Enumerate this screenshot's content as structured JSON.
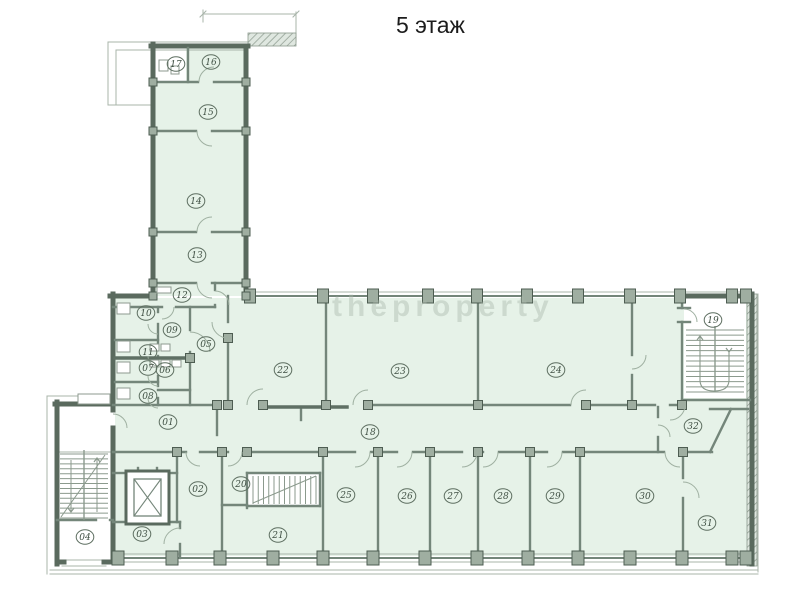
{
  "title": "5 этаж",
  "watermark": "theproperty",
  "colors": {
    "room_fill": "#e6f2e8",
    "white": "#ffffff",
    "wall_ext": "#5a6a5e",
    "wall_int": "#74867a",
    "wall_dark": "#5f7064",
    "thin": "#a8b4aa",
    "door": "#9fb0a1",
    "stair": "#8b9a8d",
    "post_fill": "#9fae a1",
    "post_fill_fixed": "#9faea1",
    "post_stroke": "#4e5d52",
    "label": "#3f4f43",
    "label_ring": "#5d6e60",
    "fixture": "#8d9a8f",
    "hatch": "#8b998d"
  },
  "rooms": [
    {
      "n": "01",
      "x": 168,
      "y": 422
    },
    {
      "n": "02",
      "x": 198,
      "y": 489
    },
    {
      "n": "03",
      "x": 142,
      "y": 534
    },
    {
      "n": "04",
      "x": 85,
      "y": 537
    },
    {
      "n": "05",
      "x": 206,
      "y": 344
    },
    {
      "n": "06",
      "x": 165,
      "y": 370
    },
    {
      "n": "07",
      "x": 148,
      "y": 368
    },
    {
      "n": "08",
      "x": 148,
      "y": 396
    },
    {
      "n": "09",
      "x": 172,
      "y": 330
    },
    {
      "n": "10",
      "x": 146,
      "y": 313
    },
    {
      "n": "11",
      "x": 148,
      "y": 352
    },
    {
      "n": "12",
      "x": 182,
      "y": 295
    },
    {
      "n": "13",
      "x": 197,
      "y": 255
    },
    {
      "n": "14",
      "x": 196,
      "y": 201
    },
    {
      "n": "15",
      "x": 208,
      "y": 112
    },
    {
      "n": "16",
      "x": 211,
      "y": 62
    },
    {
      "n": "17",
      "x": 176,
      "y": 64
    },
    {
      "n": "18",
      "x": 370,
      "y": 432
    },
    {
      "n": "19",
      "x": 713,
      "y": 320
    },
    {
      "n": "20",
      "x": 241,
      "y": 484
    },
    {
      "n": "21",
      "x": 278,
      "y": 535
    },
    {
      "n": "22",
      "x": 283,
      "y": 370
    },
    {
      "n": "23",
      "x": 400,
      "y": 371
    },
    {
      "n": "24",
      "x": 556,
      "y": 370
    },
    {
      "n": "25",
      "x": 346,
      "y": 495
    },
    {
      "n": "26",
      "x": 407,
      "y": 496
    },
    {
      "n": "27",
      "x": 453,
      "y": 496
    },
    {
      "n": "28",
      "x": 503,
      "y": 496
    },
    {
      "n": "29",
      "x": 555,
      "y": 496
    },
    {
      "n": "30",
      "x": 645,
      "y": 496
    },
    {
      "n": "31",
      "x": 707,
      "y": 523
    },
    {
      "n": "32",
      "x": 693,
      "y": 426
    }
  ],
  "plan": {
    "green": [
      [
        155,
        48,
        89,
        248
      ],
      [
        115,
        298,
        635,
        258
      ]
    ],
    "white": [
      [
        155,
        48,
        31,
        34
      ],
      [
        684,
        298,
        62,
        100
      ],
      [
        248,
        474,
        71,
        31
      ],
      [
        126,
        471,
        43,
        53
      ]
    ],
    "walls_ext": [
      [
        153,
        44,
        153,
        298
      ],
      [
        151,
        46,
        248,
        46
      ],
      [
        246,
        46,
        246,
        298
      ],
      [
        110,
        296,
        155,
        296
      ],
      [
        680,
        296,
        750,
        296
      ],
      [
        113,
        294,
        113,
        410
      ],
      [
        113,
        428,
        113,
        562
      ],
      [
        752,
        294,
        752,
        564
      ],
      [
        57,
        402,
        57,
        564
      ],
      [
        55,
        404,
        113,
        404
      ],
      [
        57,
        562,
        64,
        562
      ],
      [
        104,
        562,
        113,
        562
      ]
    ],
    "walls_glass": [
      [
        244,
        296,
        680,
        296
      ],
      [
        113,
        558,
        752,
        558
      ]
    ],
    "walls_int": [
      [
        188,
        48,
        188,
        82
      ],
      [
        153,
        82,
        198,
        82
      ],
      [
        214,
        82,
        246,
        82
      ],
      [
        153,
        131,
        196,
        131
      ],
      [
        212,
        131,
        246,
        131
      ],
      [
        153,
        232,
        196,
        232
      ],
      [
        212,
        232,
        246,
        232
      ],
      [
        153,
        283,
        196,
        283
      ],
      [
        212,
        283,
        246,
        283
      ],
      [
        215,
        283,
        215,
        290
      ],
      [
        215,
        305,
        215,
        307
      ],
      [
        113,
        307,
        162,
        307
      ],
      [
        176,
        307,
        215,
        307
      ],
      [
        158,
        307,
        158,
        312
      ],
      [
        158,
        324,
        158,
        344
      ],
      [
        158,
        356,
        158,
        364
      ],
      [
        158,
        376,
        158,
        386
      ],
      [
        158,
        398,
        158,
        405
      ],
      [
        115,
        340,
        158,
        340
      ],
      [
        115,
        382,
        158,
        382
      ],
      [
        158,
        390,
        190,
        390
      ],
      [
        190,
        307,
        190,
        330
      ],
      [
        190,
        352,
        190,
        405
      ],
      [
        228,
        296,
        228,
        322
      ],
      [
        228,
        338,
        228,
        405
      ],
      [
        326,
        296,
        326,
        405
      ],
      [
        478,
        296,
        478,
        405
      ],
      [
        632,
        296,
        632,
        355
      ],
      [
        632,
        375,
        632,
        405
      ],
      [
        682,
        296,
        682,
        308
      ],
      [
        682,
        322,
        682,
        400
      ],
      [
        682,
        400,
        750,
        400
      ],
      [
        113,
        405,
        213,
        405
      ],
      [
        301,
        407,
        301,
        420
      ],
      [
        368,
        405,
        570,
        405
      ],
      [
        586,
        405,
        655,
        405
      ],
      [
        670,
        405,
        684,
        405
      ],
      [
        217,
        405,
        217,
        435
      ],
      [
        710,
        409,
        748,
        409
      ],
      [
        658,
        407,
        658,
        417
      ],
      [
        658,
        437,
        658,
        452
      ],
      [
        710,
        452,
        731,
        409
      ],
      [
        113,
        452,
        186,
        452
      ],
      [
        200,
        452,
        228,
        452
      ],
      [
        243,
        452,
        355,
        452
      ],
      [
        371,
        452,
        397,
        452
      ],
      [
        413,
        452,
        462,
        452
      ],
      [
        478,
        452,
        483,
        452
      ],
      [
        499,
        452,
        547,
        452
      ],
      [
        563,
        452,
        664,
        452
      ],
      [
        680,
        452,
        712,
        452
      ],
      [
        177,
        452,
        177,
        522
      ],
      [
        222,
        452,
        222,
        558
      ],
      [
        247,
        473,
        247,
        508
      ],
      [
        222,
        505,
        247,
        505
      ],
      [
        247,
        473,
        320,
        473
      ],
      [
        247,
        506,
        320,
        506
      ],
      [
        320,
        473,
        320,
        506
      ],
      [
        323,
        452,
        323,
        558
      ],
      [
        378,
        452,
        378,
        558
      ],
      [
        430,
        452,
        430,
        558
      ],
      [
        478,
        452,
        478,
        558
      ],
      [
        530,
        452,
        530,
        558
      ],
      [
        580,
        452,
        580,
        558
      ],
      [
        683,
        452,
        683,
        478
      ],
      [
        683,
        498,
        683,
        558
      ],
      [
        113,
        473,
        126,
        473
      ],
      [
        169,
        473,
        177,
        473
      ],
      [
        113,
        522,
        180,
        522
      ],
      [
        180,
        522,
        180,
        528
      ],
      [
        180,
        544,
        180,
        558
      ],
      [
        57,
        520,
        96,
        520
      ],
      [
        110,
        520,
        113,
        520
      ],
      [
        138,
        468,
        138,
        477
      ],
      [
        157,
        468,
        157,
        477
      ],
      [
        678,
        308,
        690,
        308
      ],
      [
        678,
        322,
        690,
        322
      ]
    ],
    "walls_dark": [
      [
        115,
        358,
        190,
        358
      ],
      [
        262,
        407,
        347,
        407
      ]
    ],
    "thin": [
      [
        108,
        42,
        296,
        42
      ],
      [
        116,
        50,
        248,
        50
      ],
      [
        108,
        42,
        108,
        105
      ],
      [
        116,
        50,
        116,
        105
      ],
      [
        108,
        105,
        153,
        105
      ],
      [
        296,
        12,
        296,
        42
      ],
      [
        203,
        14,
        296,
        14
      ],
      [
        203,
        10,
        203,
        22
      ],
      [
        200,
        17,
        206,
        11
      ],
      [
        293,
        17,
        299,
        11
      ],
      [
        246,
        292,
        748,
        292
      ],
      [
        113,
        554,
        750,
        554
      ],
      [
        113,
        562,
        750,
        562
      ],
      [
        50,
        570,
        758,
        570
      ],
      [
        50,
        574,
        758,
        574
      ],
      [
        758,
        294,
        758,
        572
      ],
      [
        47,
        396,
        47,
        574
      ],
      [
        47,
        396,
        80,
        396
      ],
      [
        57,
        452,
        113,
        452
      ],
      [
        78,
        399,
        110,
        399
      ],
      [
        62,
        560,
        106,
        560
      ],
      [
        62,
        566,
        106,
        566
      ]
    ],
    "doors": [
      [
        214,
        82,
        15,
        180,
        270
      ],
      [
        212,
        131,
        15,
        90,
        180
      ],
      [
        212,
        232,
        15,
        180,
        270
      ],
      [
        212,
        283,
        15,
        90,
        180
      ],
      [
        215,
        305,
        14,
        270,
        360
      ],
      [
        158,
        324,
        10,
        90,
        180
      ],
      [
        158,
        356,
        10,
        90,
        180
      ],
      [
        158,
        376,
        10,
        90,
        180
      ],
      [
        158,
        398,
        10,
        90,
        180
      ],
      [
        162,
        307,
        12,
        0,
        90
      ],
      [
        190,
        352,
        20,
        270,
        360
      ],
      [
        228,
        322,
        16,
        90,
        180
      ],
      [
        263,
        405,
        16,
        180,
        270
      ],
      [
        368,
        405,
        15,
        180,
        270
      ],
      [
        586,
        405,
        15,
        180,
        270
      ],
      [
        670,
        405,
        15,
        0,
        90
      ],
      [
        632,
        355,
        14,
        0,
        90
      ],
      [
        684,
        322,
        13,
        270,
        360
      ],
      [
        658,
        437,
        12,
        270,
        360
      ],
      [
        200,
        452,
        14,
        90,
        180
      ],
      [
        228,
        452,
        14,
        0,
        90
      ],
      [
        355,
        452,
        15,
        0,
        90
      ],
      [
        397,
        452,
        15,
        0,
        90
      ],
      [
        462,
        452,
        15,
        0,
        90
      ],
      [
        483,
        452,
        15,
        0,
        90
      ],
      [
        547,
        452,
        15,
        0,
        90
      ],
      [
        680,
        452,
        15,
        90,
        180
      ],
      [
        683,
        498,
        16,
        270,
        360
      ],
      [
        180,
        544,
        16,
        180,
        270
      ],
      [
        113,
        428,
        14,
        270,
        360
      ]
    ],
    "posts_top": {
      "y": 296,
      "w": 11,
      "h": 14,
      "xs": [
        250,
        323,
        373,
        428,
        477,
        527,
        578,
        630,
        680,
        732,
        746
      ]
    },
    "posts_bottom": {
      "y": 558,
      "w": 12,
      "h": 14,
      "xs": [
        118,
        172,
        220,
        273,
        323,
        373,
        425,
        477,
        528,
        578,
        630,
        682,
        732,
        746
      ]
    },
    "posts_wing": {
      "s": 8,
      "pts": [
        [
          153,
          82
        ],
        [
          246,
          82
        ],
        [
          153,
          131
        ],
        [
          246,
          131
        ],
        [
          153,
          232
        ],
        [
          246,
          232
        ],
        [
          153,
          283
        ],
        [
          246,
          283
        ],
        [
          153,
          296
        ],
        [
          246,
          296
        ]
      ]
    },
    "posts_junction": {
      "s": 9,
      "pts": [
        [
          228,
          405
        ],
        [
          326,
          405
        ],
        [
          478,
          405
        ],
        [
          632,
          405
        ],
        [
          682,
          405
        ],
        [
          217,
          405
        ],
        [
          263,
          405
        ],
        [
          368,
          405
        ],
        [
          586,
          405
        ],
        [
          177,
          452
        ],
        [
          222,
          452
        ],
        [
          247,
          452
        ],
        [
          323,
          452
        ],
        [
          378,
          452
        ],
        [
          430,
          452
        ],
        [
          478,
          452
        ],
        [
          530,
          452
        ],
        [
          580,
          452
        ],
        [
          683,
          452
        ],
        [
          190,
          358
        ],
        [
          228,
          338
        ]
      ]
    },
    "stairs_left": {
      "x1": 60,
      "x2": 108,
      "y1": 454,
      "y2": 518,
      "n": 13,
      "center": [
        84,
        450,
        84,
        520
      ],
      "diag": [
        61,
        517,
        105,
        455
      ],
      "arrows": [
        {
          "x": 97,
          "y1": 512,
          "y2": 458,
          "head": "up"
        },
        {
          "x": 71,
          "y1": 460,
          "y2": 512,
          "head": "down"
        }
      ]
    },
    "stairs_box20": {
      "y1": 476,
      "y2": 504,
      "x1": 253,
      "x2": 316,
      "n": 12,
      "diag": [
        253,
        503,
        316,
        476
      ]
    },
    "stairs_19": {
      "x1": 686,
      "x2": 744,
      "y1": 330,
      "y2": 392,
      "n": 12,
      "center": [
        715,
        326,
        715,
        392
      ],
      "upath": "M 700 336 L 700 380 Q 700 391 714 391 Q 729 391 729 380 L 729 352",
      "heads": [
        {
          "x": 700,
          "y": 336,
          "dir": "up"
        },
        {
          "x": 729,
          "y": 352,
          "dir": "down"
        }
      ]
    },
    "elevator": {
      "shaft": [
        126,
        471,
        43,
        53
      ],
      "cab": [
        134,
        479,
        27,
        37
      ]
    },
    "fixtures": [
      [
        117,
        303,
        13,
        11
      ],
      [
        117,
        341,
        13,
        11
      ],
      [
        117,
        362,
        13,
        11
      ],
      [
        117,
        388,
        13,
        11
      ],
      [
        150,
        344,
        9,
        7
      ],
      [
        161,
        344,
        9,
        7
      ],
      [
        150,
        360,
        9,
        7
      ],
      [
        161,
        360,
        9,
        7
      ],
      [
        172,
        360,
        9,
        7
      ],
      [
        159,
        60,
        9,
        11
      ],
      [
        171,
        66,
        8,
        8
      ],
      [
        157,
        287,
        14,
        6
      ],
      [
        78,
        394,
        32,
        10
      ]
    ],
    "hatch_rects": [
      [
        248,
        33,
        48,
        13
      ],
      [
        747,
        294,
        10,
        272
      ]
    ]
  }
}
